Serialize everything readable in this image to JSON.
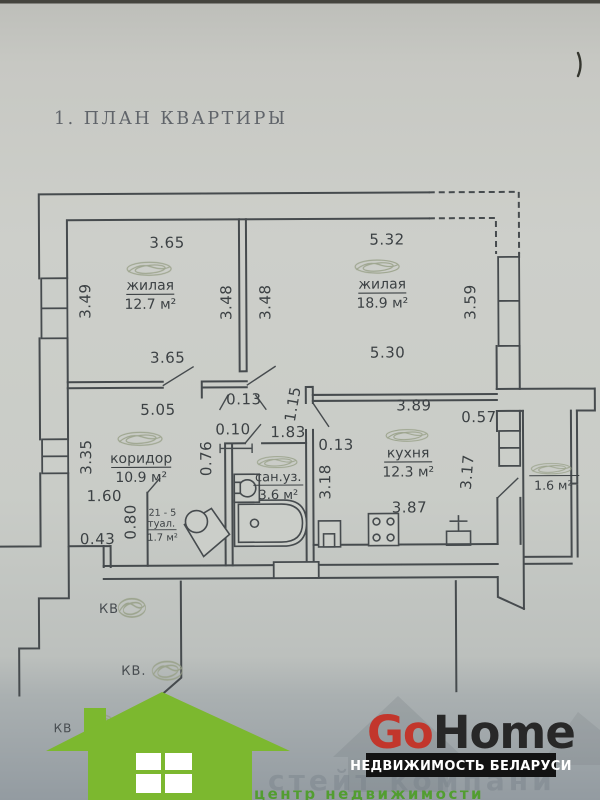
{
  "title": "1. ПЛАН КВАРТИРЫ",
  "rooms": {
    "living1": {
      "name": "жилая",
      "area": "12.7 м²"
    },
    "living2": {
      "name": "жилая",
      "area": "18.9 м²"
    },
    "corridor": {
      "name": "коридор",
      "area": "10.9 м²"
    },
    "bathroom": {
      "name": "сан.уз.",
      "area": "3.6 м²"
    },
    "kitchen": {
      "name": "кухня",
      "area": "12.3 м²"
    },
    "toilet": {
      "number": "21 - 5",
      "name": "туал.",
      "area": "1.7 м²"
    },
    "balcony": {
      "area": "1.6 м²"
    }
  },
  "dims": {
    "living1_top": "3.65",
    "living1_left": "3.49",
    "living1_right": "3.48",
    "living2_left": "3.48",
    "living1_bottom": "3.65",
    "living2_top": "5.32",
    "living2_right": "3.59",
    "living2_bottom": "5.30",
    "corridor_top": "5.05",
    "corridor_left": "3.35",
    "wall_013_a": "0.13",
    "niche_010": "0.10",
    "wall_076": "0.76",
    "bath_door": "1.83",
    "wall_115": "1.15",
    "wall_013_b": "0.13",
    "bath_right": "3.18",
    "kitchen_top": "3.89",
    "kitchen_win": "0.57",
    "kitchen_right": "3.17",
    "kitchen_bottom": "3.87",
    "hall_160": "1.60",
    "hall_080": "0.80",
    "hall_043": "0.43"
  },
  "neighbors": {
    "kv1": "КВ",
    "kv2": "КВ.",
    "kv3": "КВ"
  },
  "logo": {
    "brand_go": "Go",
    "brand_home": "Home",
    "tagline": "НЕДВИЖИМОСТЬ БЕЛАРУСИ"
  },
  "watermark": {
    "gray": "стейт компани",
    "green": "центр недвижимости"
  },
  "colors": {
    "logo_green": "#7cb82f",
    "logo_red": "#c2362c",
    "tagline_bg": "#131313",
    "line": "#464b4e",
    "paper": "#cbcec9"
  }
}
